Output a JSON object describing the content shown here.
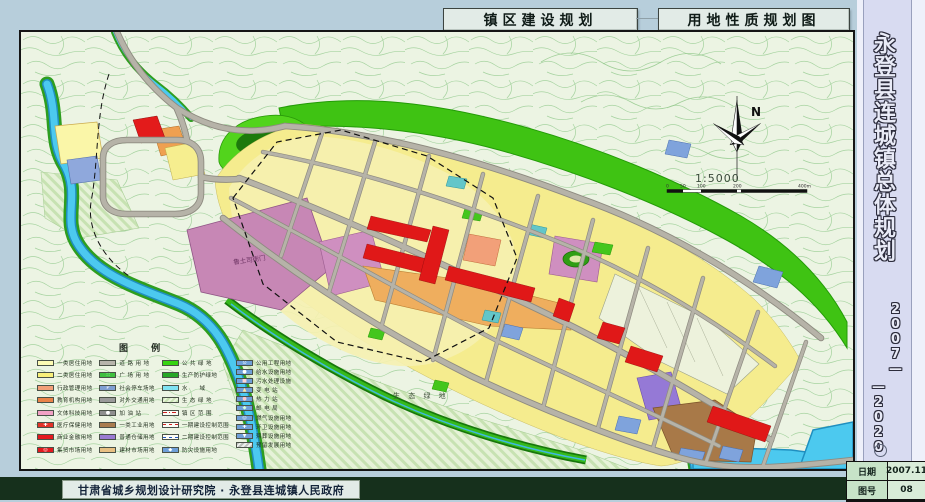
{
  "header": {
    "title_left": "镇区建设规划",
    "title_right": "用地性质规划图"
  },
  "sidebar": {
    "title": "永登县连城镇总体规划",
    "period_right": "2007—",
    "period_left": "—2020"
  },
  "titleblock": {
    "date_label": "日期",
    "date_value": "2007.11",
    "sheet_label": "图号",
    "sheet_value": "08"
  },
  "footer": {
    "credit": "甘肃省城乡规划设计研究院 · 永登县连城镇人民政府"
  },
  "map": {
    "north_label": "N",
    "scale_text": "1:5000",
    "scale_ticks": [
      "0",
      "50",
      "100",
      "200",
      "400m"
    ],
    "labels": {
      "eco": "生 态 绿 地",
      "landmark": "鲁土司衙门"
    },
    "colors": {
      "residential_yellow": "#f5ec8e",
      "road_gray": "#b6b3a8",
      "water_cyan": "#4cc9ef",
      "green_belt": "#3fc313",
      "commercial_red": "#e01818",
      "historic_mauve": "#c787b5",
      "industrial_brown": "#a87948",
      "warehouse_purple": "#9579d6",
      "market_orange": "#efae5e"
    }
  },
  "legend": {
    "title": "图  例",
    "columns": [
      {
        "items": [
          {
            "label": "一类居住用地",
            "color": "#fdfbb4"
          },
          {
            "label": "二类居住用地",
            "color": "#f9f07a"
          },
          {
            "label": "行政管理用地",
            "color": "#f2a079"
          },
          {
            "label": "教育机构用地",
            "color": "#ea8348"
          },
          {
            "label": "文体科技用地",
            "color": "#f2a2c5"
          },
          {
            "label": "医疗保健用地",
            "color": "#e23328",
            "glyph": "✚",
            "glyphColor": "#ffffff"
          },
          {
            "label": "商业金融用地",
            "color": "#e4191f"
          },
          {
            "label": "集贸市场用地",
            "color": "#e4191f",
            "glyph": "◎",
            "glyphColor": "#ffffff"
          }
        ]
      },
      {
        "items": [
          {
            "label": "道 路 用 地",
            "color": "#b7b4ac"
          },
          {
            "label": "广 场 用 地",
            "color": "#3fbf3f",
            "glyph": "∷",
            "glyphColor": "#eaffea"
          },
          {
            "label": "社会停车场地",
            "color": "#7f9fd2",
            "glyph": "P",
            "glyphColor": "#ffffff"
          },
          {
            "label": "对外交通用地",
            "color": "#9a9a9a"
          },
          {
            "label": "加 油 站",
            "color": "#8f8f8f",
            "glyph": "●",
            "glyphColor": "#ffffff"
          },
          {
            "label": "一类工业用地",
            "color": "#a97c4f"
          },
          {
            "label": "普通仓储用地",
            "color": "#9a7ad2"
          },
          {
            "label": "建材市场用地",
            "color": "#e8c083"
          }
        ]
      },
      {
        "items": [
          {
            "label": "公 共 绿 地",
            "color": "#35d411"
          },
          {
            "label": "生产防护绿地",
            "color": "#27a727"
          },
          {
            "label": "水　　域",
            "color": "#7fe3f2"
          },
          {
            "label": "生 态 绿 地",
            "pattern": "hatch"
          },
          {
            "label": "镇 区 范 围",
            "line": "dashdot-red"
          },
          {
            "label": "一期建设控制范围",
            "line": "dash-red"
          },
          {
            "label": "二期建设控制范围",
            "line": "dash-blue"
          },
          {
            "label": "防灾设施用地",
            "color": "#6f9fd8",
            "glyph": "◆",
            "glyphColor": "#ffffff"
          }
        ]
      },
      {
        "items": [
          {
            "label": "公用工程用地",
            "color": "#6f9fd8",
            "glyph": "⊙",
            "glyphColor": "#ffffff"
          },
          {
            "label": "给水设施用地",
            "color": "#6f9fd8",
            "glyph": "●",
            "glyphColor": "#ffffff"
          },
          {
            "label": "污水处理设施",
            "color": "#6f9fd8",
            "glyph": "■",
            "glyphColor": "#ffd5d5"
          },
          {
            "label": "变 电 站",
            "color": "#6f9fd8",
            "glyph": "▲",
            "glyphColor": "#ffe9a0"
          },
          {
            "label": "热 力 站",
            "color": "#6f9fd8",
            "glyph": "●",
            "glyphColor": "#ffc9c9"
          },
          {
            "label": "邮 电 局",
            "color": "#6f9fd8",
            "glyph": "◆",
            "glyphColor": "#d8ffd8"
          },
          {
            "label": "燃气设施用地",
            "color": "#6f9fd8",
            "glyph": "◎",
            "glyphColor": "#ffffff"
          },
          {
            "label": "环卫设施用地",
            "color": "#6f9fd8",
            "glyph": "✚",
            "glyphColor": "#ffffff"
          },
          {
            "label": "殡葬设施用地",
            "color": "#6f9fd8",
            "glyph": "▼",
            "glyphColor": "#ffffff"
          },
          {
            "label": "预留发展用地",
            "pattern": "hatch-gray"
          }
        ]
      }
    ]
  }
}
